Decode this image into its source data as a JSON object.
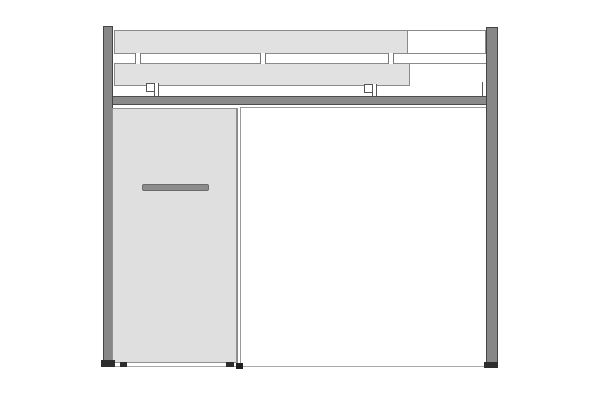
{
  "diagram": {
    "type": "furniture_elevation_drawing",
    "canvas": {
      "width": 600,
      "height": 400
    },
    "palette": {
      "background": "#ffffff",
      "frame_fill": "#878787",
      "frame_edge": "#454545",
      "panel_fill": "#e1e1e1",
      "panel_border": "#8a8a8a",
      "handle_fill": "#8c8c8c",
      "handle_edge": "#6b6b6b",
      "foot_fill": "#2d2d2d",
      "thin_line": "#999999"
    },
    "parts": {
      "shelf_top_outline": {
        "x": 114,
        "y": 30,
        "w": 372,
        "h": 24,
        "fill": "#ffffff",
        "border": "1px solid #8a8a8a"
      },
      "shelf_top_fill": {
        "x": 114,
        "y": 30,
        "w": 294,
        "h": 24,
        "fill": "#e1e1e1",
        "border": "1px solid #8a8a8a"
      },
      "shelf_bottom_fill": {
        "x": 114,
        "y": 63,
        "w": 296,
        "h": 23,
        "fill": "#e1e1e1",
        "border": "1px solid #8a8a8a"
      },
      "shelf_bottom_edge_line": {
        "x": 410,
        "y": 63,
        "w": 76,
        "h": 1,
        "fill": "#8a8a8a"
      },
      "tick_left": {
        "x": 135,
        "y": 53,
        "w": 6,
        "h": 11,
        "fill": "#ffffff",
        "bl": "1px solid #777777",
        "br": "1px solid #777777"
      },
      "tick_middle": {
        "x": 260,
        "y": 53,
        "w": 6,
        "h": 11,
        "fill": "#ffffff",
        "bl": "1px solid #777777",
        "br": "1px solid #777777"
      },
      "tick_right": {
        "x": 388,
        "y": 53,
        "w": 6,
        "h": 11,
        "fill": "#ffffff",
        "bl": "1px solid #777777",
        "br": "1px solid #777777"
      },
      "clip_left_square": {
        "x": 146,
        "y": 83,
        "w": 9,
        "h": 9,
        "fill": "#ffffff",
        "border": "1px solid #555555"
      },
      "clip_left_stem": {
        "x": 154,
        "y": 83,
        "w": 5,
        "h": 14,
        "fill": "#ffffff",
        "bl": "1px solid #555555",
        "br": "1px solid #555555"
      },
      "clip_right_square": {
        "x": 364,
        "y": 84,
        "w": 9,
        "h": 9,
        "fill": "#ffffff",
        "border": "1px solid #555555"
      },
      "clip_right_stem": {
        "x": 372,
        "y": 84,
        "w": 5,
        "h": 13,
        "fill": "#ffffff",
        "bl": "1px solid #555555",
        "br": "1px solid #555555"
      },
      "clip_post_stem": {
        "x": 482,
        "y": 82,
        "w": 5,
        "h": 15,
        "fill": "#ffffff",
        "bl": "1px solid #555555",
        "br": "1px solid #555555"
      },
      "beam": {
        "x": 103,
        "y": 96,
        "w": 395,
        "h": 9,
        "fill": "#8a8a8a",
        "border": "1px solid #4d4d4d"
      },
      "left_post": {
        "x": 103,
        "y": 26,
        "w": 10,
        "h": 340,
        "fill": "#878787",
        "border": "1px solid #454545"
      },
      "right_post": {
        "x": 486,
        "y": 27,
        "w": 12,
        "h": 341,
        "fill": "#878787",
        "border": "1px solid #454545"
      },
      "door": {
        "x": 112,
        "y": 108,
        "w": 125,
        "h": 255,
        "fill": "#dfdfdf",
        "border": "1px solid #909090"
      },
      "door_handle": {
        "x": 142,
        "y": 184,
        "w": 67,
        "h": 7,
        "fill": "#8c8c8c",
        "border": "1px solid #6b6b6b",
        "radius": "2px"
      },
      "opening_panel": {
        "x": 240,
        "y": 107,
        "w": 246,
        "h": 260,
        "fill": "#ffffff",
        "bt": "1px solid #9a9a9a",
        "bb": "1px solid #8a8a8a"
      },
      "divider_edge": {
        "x": 237,
        "y": 108,
        "w": 4,
        "h": 258,
        "fill": "#ffffff",
        "bl": "1px solid #8a8a8a",
        "br": "1px solid #999999"
      },
      "floor_line": {
        "x": 113,
        "y": 366,
        "w": 373,
        "h": 1,
        "fill": "#aaaaaa"
      },
      "left_post_foot": {
        "x": 101,
        "y": 360,
        "w": 14,
        "h": 7,
        "fill": "#2d2d2d"
      },
      "door_foot_left": {
        "x": 120,
        "y": 362,
        "w": 7,
        "h": 5,
        "fill": "#2d2d2d"
      },
      "door_foot_right": {
        "x": 226,
        "y": 362,
        "w": 8,
        "h": 5,
        "fill": "#2d2d2d"
      },
      "divider_foot": {
        "x": 236,
        "y": 363,
        "w": 7,
        "h": 6,
        "fill": "#1f1f1f"
      },
      "right_post_foot": {
        "x": 484,
        "y": 362,
        "w": 14,
        "h": 6,
        "fill": "#2d2d2d"
      }
    }
  }
}
